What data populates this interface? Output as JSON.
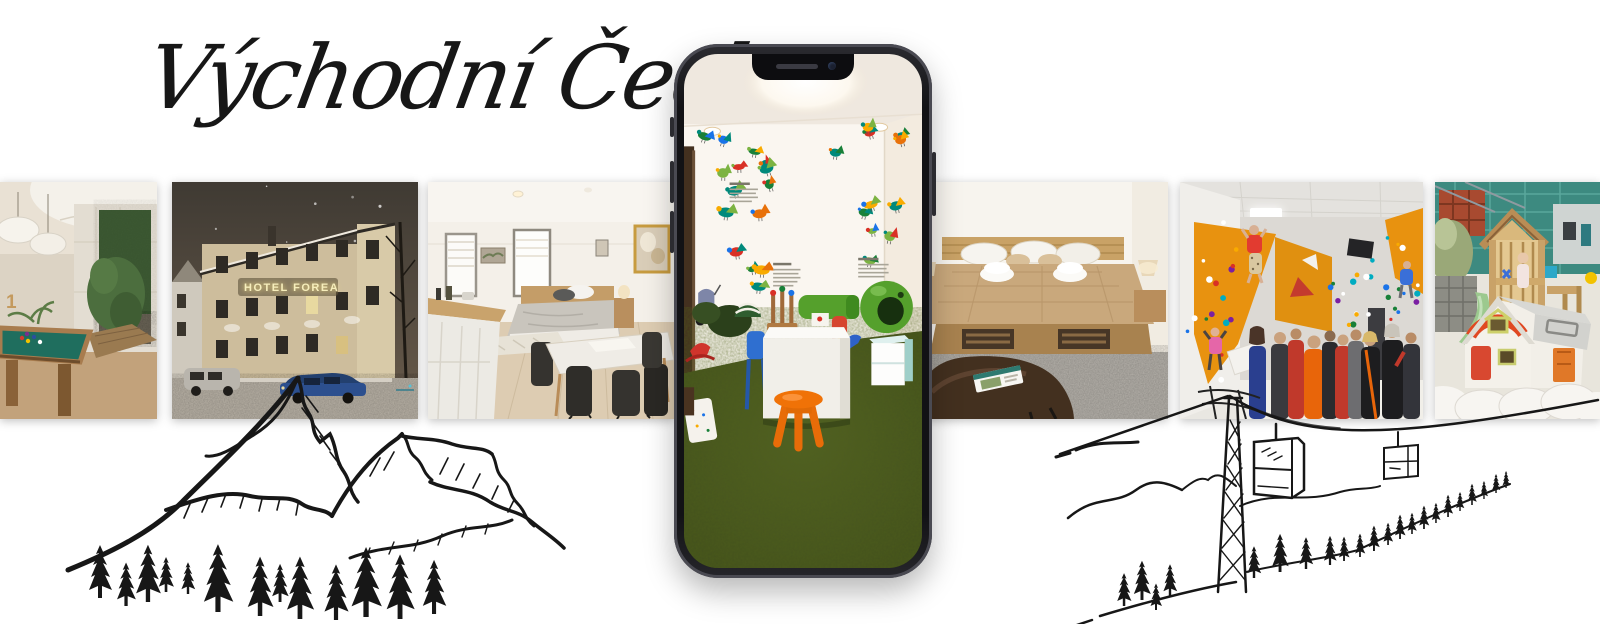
{
  "title": {
    "text": "Východní Čechy"
  },
  "photos": [
    {
      "name": "billiards-room",
      "wall_digit": "1"
    },
    {
      "name": "hotel-exterior-night",
      "sign_text": "HOTEL FOREA"
    },
    {
      "name": "apartment-studio"
    },
    {
      "name": "hotel-bedroom"
    },
    {
      "name": "climbing-gym"
    },
    {
      "name": "outdoor-playground"
    }
  ],
  "phone": {
    "screen_photo": "kids-playroom"
  },
  "playroom": {
    "decal_count": 26,
    "decal_palette": [
      "#d93025",
      "#1a73e8",
      "#188038",
      "#f9ab00",
      "#e8710a",
      "#00897b",
      "#7cb342"
    ]
  },
  "climbing": {
    "hold_count": 46,
    "hold_palette": [
      "#ffffff",
      "#d93025",
      "#1a73e8",
      "#f9ab00",
      "#188038",
      "#7b1fa2",
      "#00acc1"
    ]
  },
  "colors": {
    "paper": "#ffffff",
    "ink": "#171717",
    "frame": "#1a1a1d",
    "frame-edge": "#45454c",
    "carpet": "#47551f",
    "stool": "#f07207",
    "climb": "#e8920f",
    "felt": "#1f6e5e",
    "sign": "#f6eebc",
    "night": "#4e463c",
    "blanket": "#c9a87c",
    "playgreen": "#55a02c"
  }
}
